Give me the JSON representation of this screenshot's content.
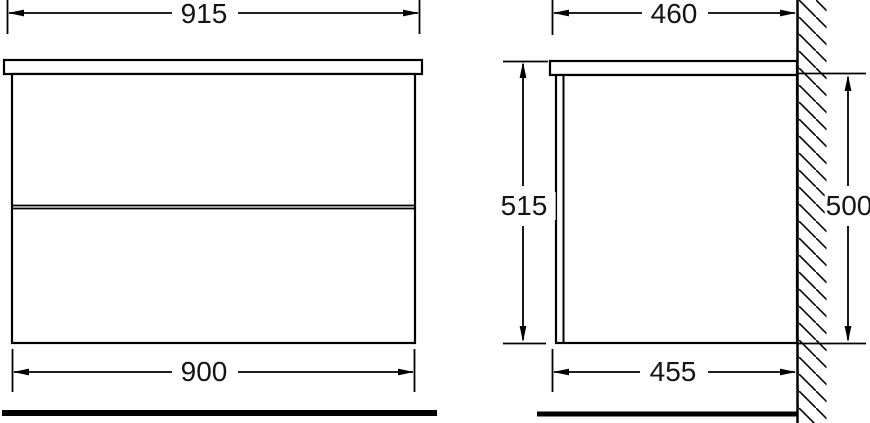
{
  "drawing": {
    "front_view": {
      "top_width": "915",
      "cabinet_width": "900"
    },
    "side_view": {
      "top_depth": "460",
      "overall_height": "515",
      "cabinet_height": "500",
      "cabinet_depth": "455"
    },
    "colors": {
      "line": "#000000",
      "background": "#ffffff",
      "text": "#141414"
    }
  }
}
